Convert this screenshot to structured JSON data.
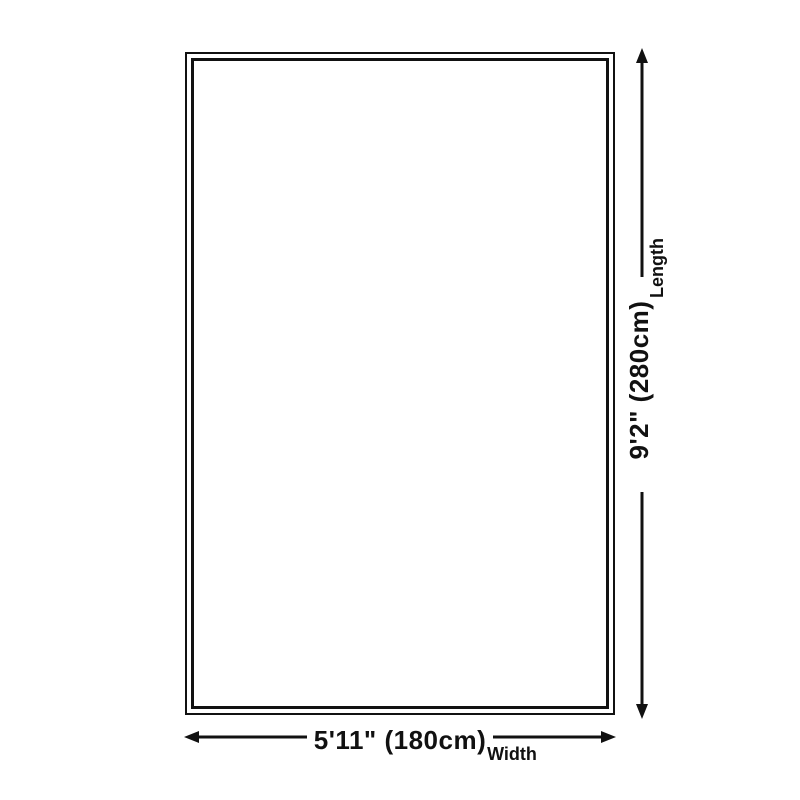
{
  "diagram": {
    "type": "product-dimension-diagram",
    "background_color": "#ffffff",
    "line_color": "#111111",
    "rug": {
      "shape": "rectangle",
      "border_style": "double-outline"
    },
    "length_dimension": {
      "value": "9'2\" (280cm)",
      "label": "Length",
      "orientation": "vertical"
    },
    "width_dimension": {
      "value": "5'11\" (180cm)",
      "label": "Width",
      "orientation": "horizontal"
    }
  }
}
